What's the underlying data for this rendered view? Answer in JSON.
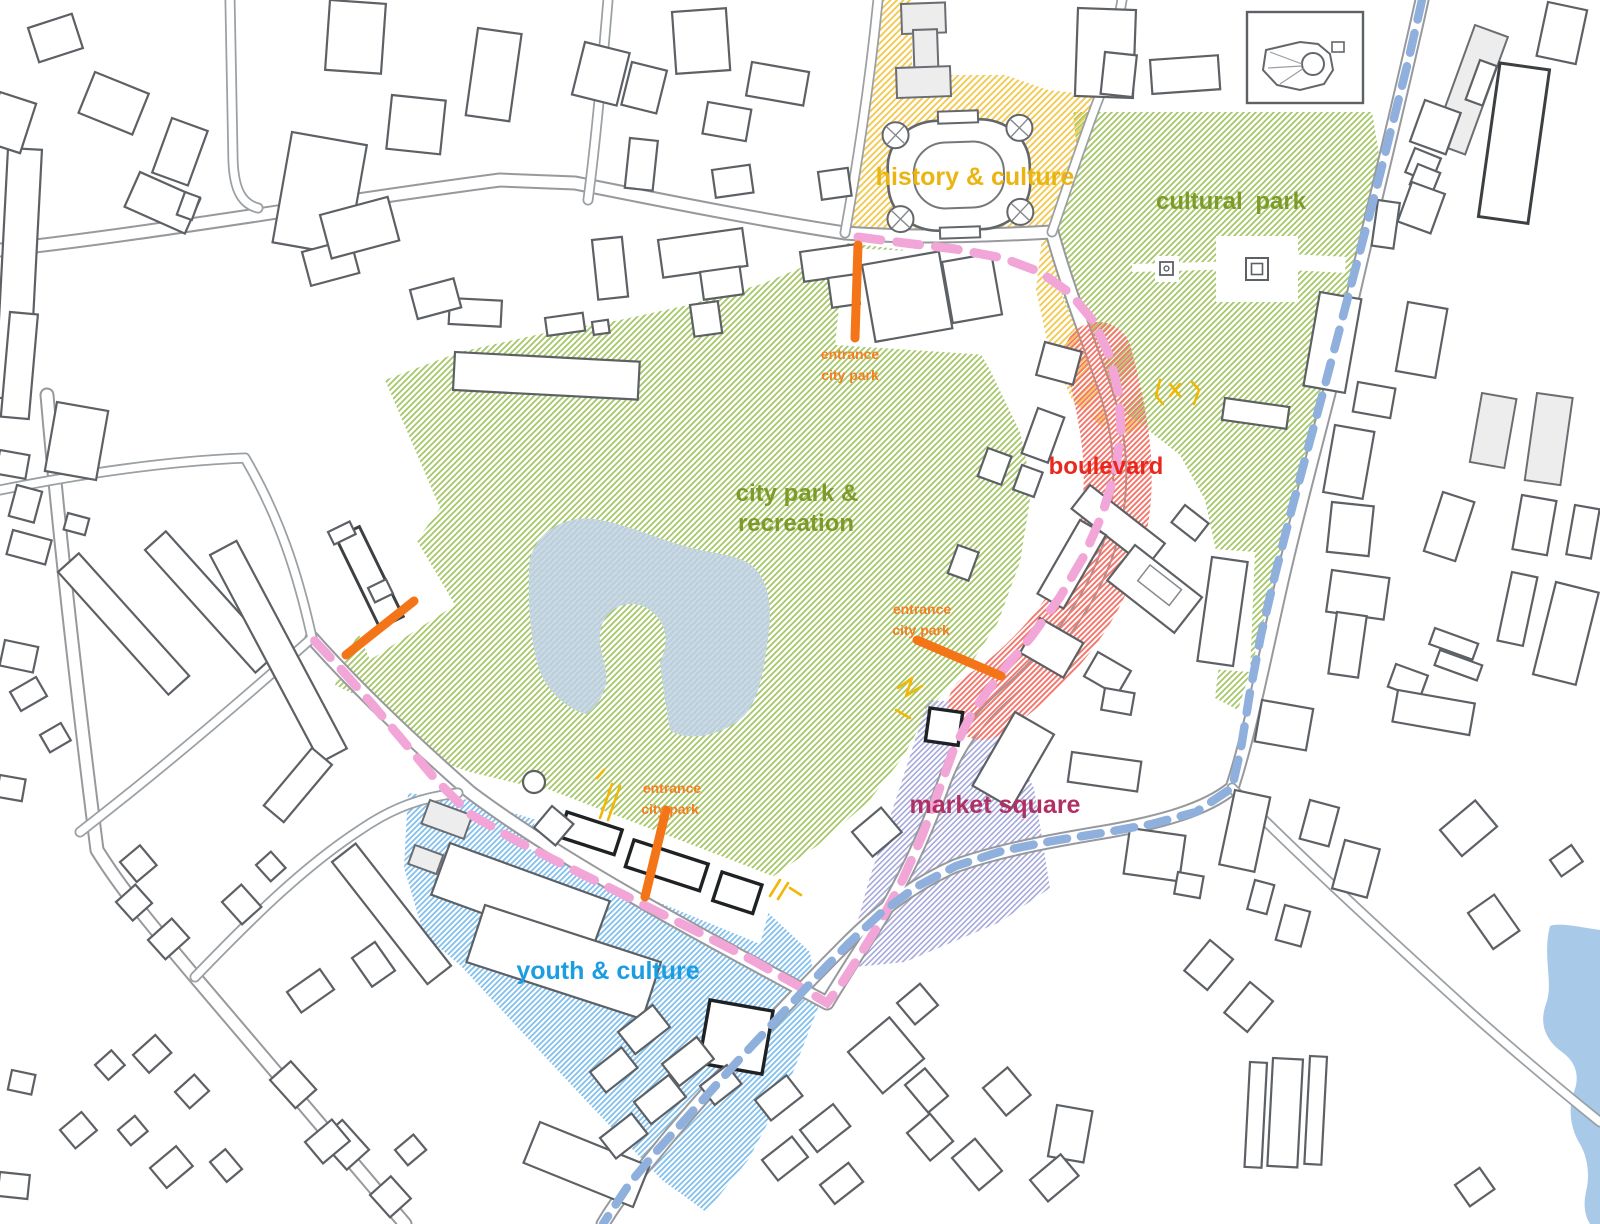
{
  "zones": {
    "history_culture": {
      "label": "history & culture",
      "text_color": "#ebb411"
    },
    "cultural_park": {
      "label": "cultural  park",
      "text_color": "#7d9b2b"
    },
    "city_park": {
      "label_line1": "city park &",
      "label_line2": "recreation",
      "text_color": "#7d9b2b"
    },
    "boulevard": {
      "label": "boulevard",
      "text_color": "#e8281e"
    },
    "market_square": {
      "label": "market square",
      "text_color": "#b13064"
    },
    "youth_culture": {
      "label": "youth & culture",
      "text_color": "#1b9de2"
    }
  },
  "entrance_marker": {
    "line1": "entrance",
    "line2": "city park",
    "color": "#f57e20",
    "label_count": 3
  },
  "routes": {
    "pink_promenade": {
      "color": "#f1a6d7",
      "style": "dashed"
    },
    "blue_ring": {
      "color": "#8fb0dd",
      "style": "dashed"
    }
  },
  "water": {
    "pond_color": "#bdd0dc",
    "river_color": "#a9c9e8"
  },
  "hatches": {
    "park_green": "#a3c763",
    "history_yellow": "#f3ca52",
    "boulevard_red": "#f3796f",
    "market_purple": "#a6a8dc",
    "youth_blue": "#82c0ee"
  }
}
